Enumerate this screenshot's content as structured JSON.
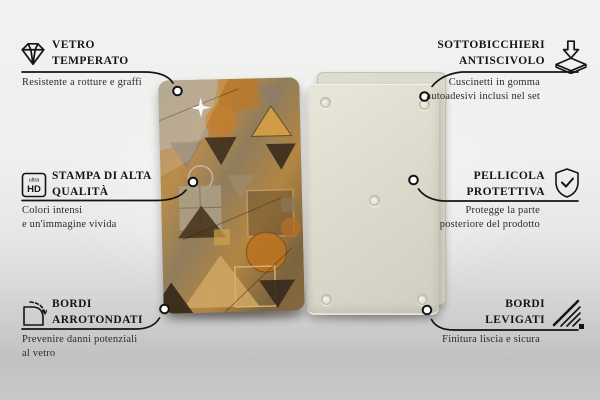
{
  "callouts": {
    "left": [
      {
        "icon": "diamond-icon",
        "title1": "VETRO",
        "title2": "TEMPERATO",
        "sub1": "Resistente a rotture e graffi",
        "sub2": ""
      },
      {
        "icon": "ultra-hd-icon",
        "title1": "STAMPA DI ALTA",
        "title2": "QUALITÀ",
        "sub1": "Colori intensi",
        "sub2": "e un'immagine vivida"
      },
      {
        "icon": "rounded-corner-icon",
        "title1": "BORDI",
        "title2": "ARROTONDATI",
        "sub1": "Prevenire danni potenziali",
        "sub2": "al vetro"
      }
    ],
    "right": [
      {
        "icon": "coaster-arrow-icon",
        "title1": "SOTTOBICCHIERI",
        "title2": "ANTISCIVOLO",
        "sub1": "Cuscinetti in gomma",
        "sub2": "autoadesivi inclusi nel set"
      },
      {
        "icon": "shield-check-icon",
        "title1": "PELLICOLA",
        "title2": "PROTETTIVA",
        "sub1": "Protegge la parte",
        "sub2": "posteriore del prodotto"
      },
      {
        "icon": "edge-hatch-icon",
        "title1": "BORDI",
        "title2": "LEVIGATI",
        "sub1": "Finitura liscia e sicura",
        "sub2": ""
      }
    ]
  },
  "icon_text": {
    "ultra": "ultra",
    "hd": "HD"
  },
  "product": {
    "front_view": "pannello frontale con motivo geometrico astratto",
    "back_view": "retro del pannello con cuscinetti",
    "pad_count": 5
  },
  "colors": {
    "line": "#141414",
    "title_text": "#151515",
    "subtitle_text": "#2b2b2b",
    "background_top": "#f2f2f1",
    "background_bottom": "#c2c2c1",
    "back_panel": "#dcdbcd",
    "back_panel_film": "#d8d7c8",
    "pattern_palette": [
      "#c2914c",
      "#93805f",
      "#c9812d",
      "#3a2b18",
      "#d9af67",
      "#b2a78f"
    ]
  }
}
